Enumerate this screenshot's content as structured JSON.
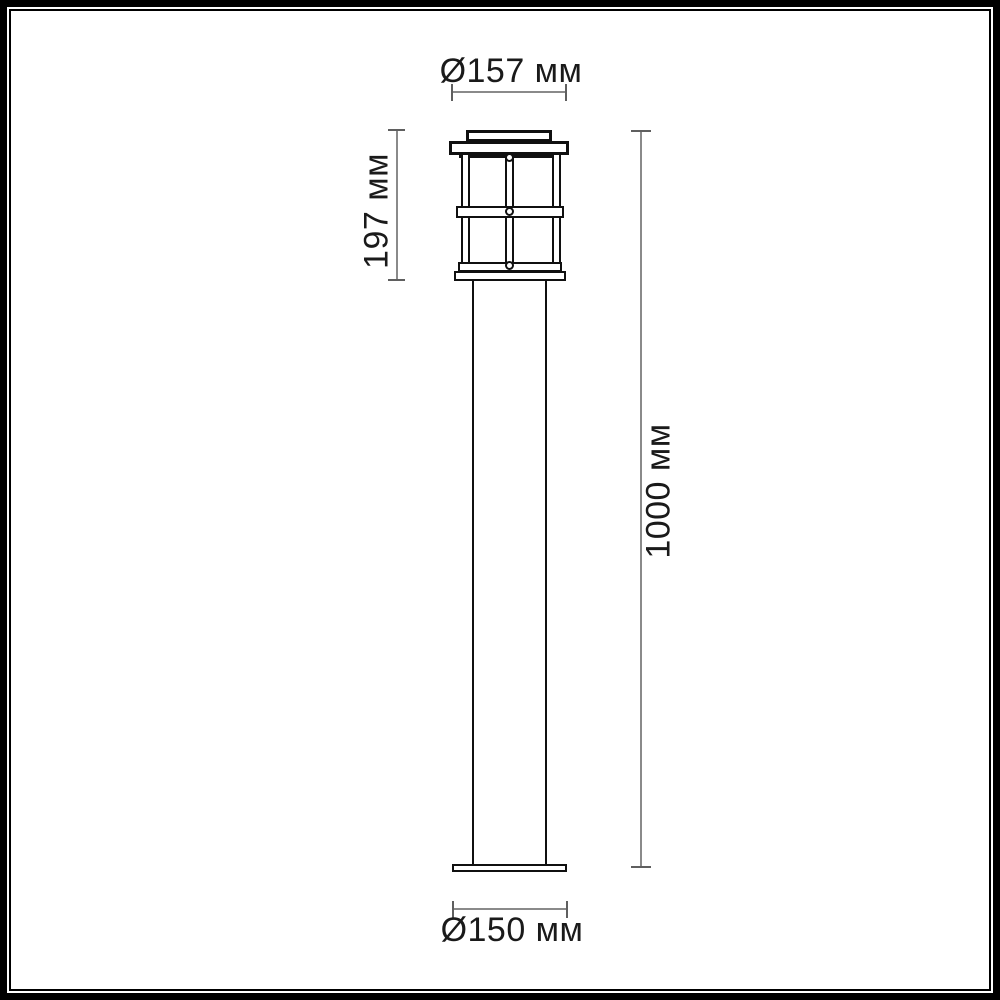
{
  "diagram": {
    "kind": "technical-dimension-drawing",
    "subject": "outdoor bollard lamp post",
    "dimensions": {
      "top_diameter": "Ø157 мм",
      "lantern_height": "197 мм",
      "total_height": "1000 мм",
      "base_diameter": "Ø150 мм"
    },
    "colors": {
      "frame": "#000000",
      "drawing_line": "#101010",
      "dimension_line": "#8a8a8a",
      "dimension_tick": "#5f5f5f",
      "text": "#1a1a1a",
      "background": "#ffffff"
    }
  }
}
